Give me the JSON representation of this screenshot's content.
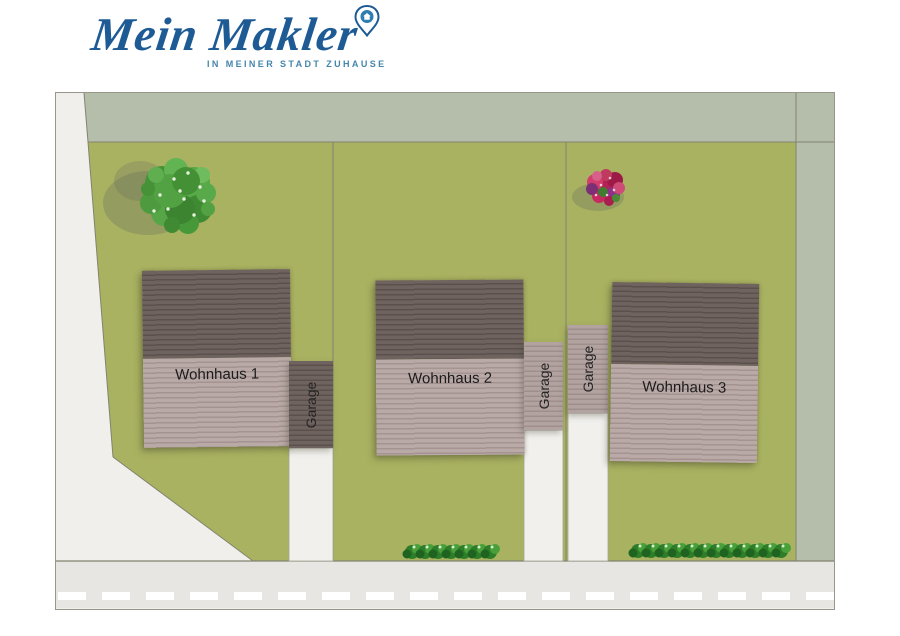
{
  "logo": {
    "brand": "Mein Makler",
    "tagline": "IN MEINER STADT ZUHAUSE",
    "brand_color": "#1e5b95",
    "tagline_color": "#4585ac",
    "pin_icon_color": "#2e7cb0"
  },
  "site_plan": {
    "houses": [
      {
        "label": "Wohnhaus 1"
      },
      {
        "label": "Wohnhaus 2"
      },
      {
        "label": "Wohnhaus 3"
      }
    ],
    "garages": [
      {
        "label": "Garage"
      },
      {
        "label": "Garage"
      },
      {
        "label": "Garage"
      }
    ],
    "colors": {
      "lawn": "#a9b261",
      "hedge_border": "#b5bdab",
      "road": "#e7e6e3",
      "path": "#f0efec",
      "roof_dark": "#6f6360",
      "roof_light": "#b9a9a7",
      "boundary_line": "#83836f",
      "road_dash": "#ffffff"
    }
  }
}
